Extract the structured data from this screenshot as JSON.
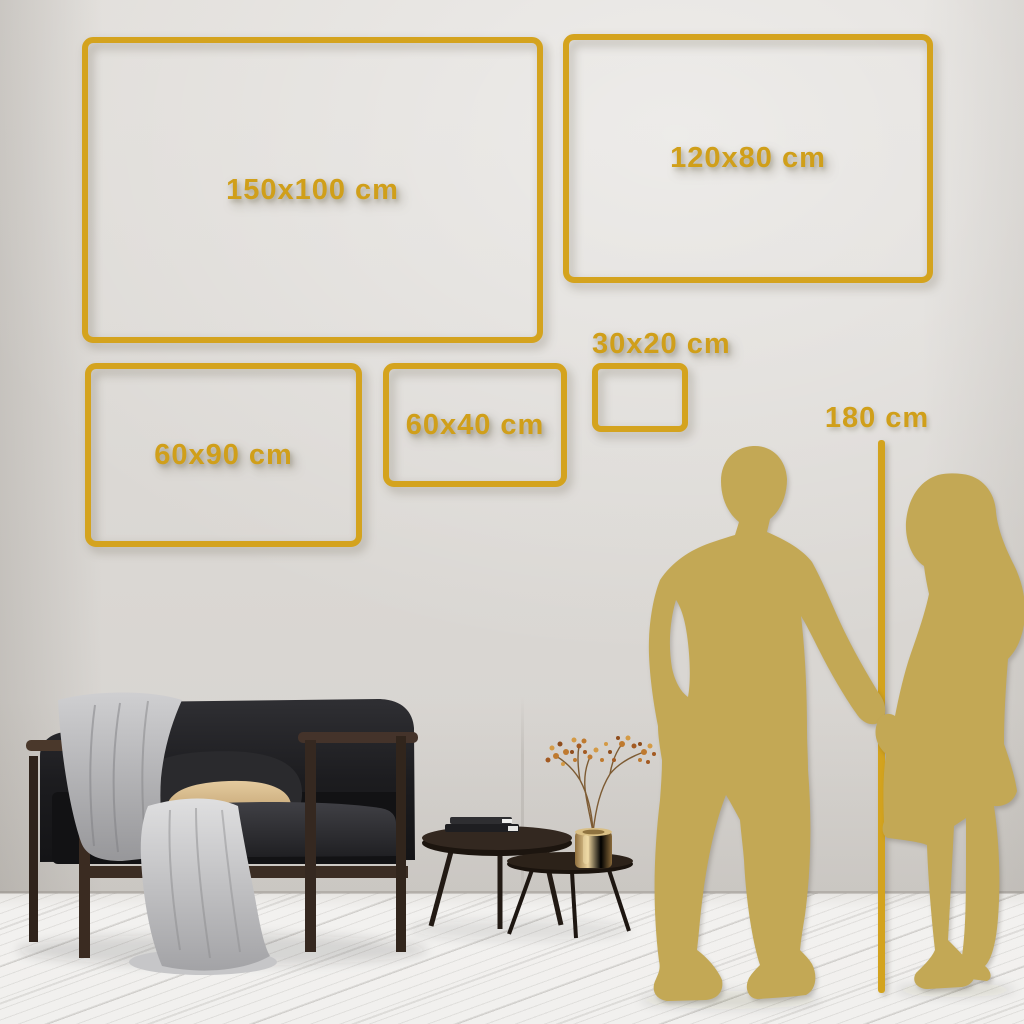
{
  "title": "Canvas wall art size guide",
  "unit": "cm",
  "colors": {
    "accent_gold": "#D4A31E",
    "silhouette_gold": "#C3A855",
    "wall": "#DBD8D4",
    "floor": "#F1F0EE"
  },
  "size_chart": {
    "type": "table",
    "frames": [
      {
        "id": "150x100",
        "label": "150x100 cm",
        "width_cm": 150,
        "height_cm": 100,
        "box_px": {
          "x": 82,
          "y": 37,
          "w": 461,
          "h": 306
        },
        "label_placement": "center"
      },
      {
        "id": "120x80",
        "label": "120x80 cm",
        "width_cm": 120,
        "height_cm": 80,
        "box_px": {
          "x": 563,
          "y": 34,
          "w": 370,
          "h": 249
        },
        "label_placement": "center"
      },
      {
        "id": "60x90",
        "label": "60x90 cm",
        "width_cm": 60,
        "height_cm": 90,
        "box_px": {
          "x": 85,
          "y": 363,
          "w": 277,
          "h": 184
        },
        "label_placement": "center"
      },
      {
        "id": "60x40",
        "label": "60x40 cm",
        "width_cm": 60,
        "height_cm": 40,
        "box_px": {
          "x": 383,
          "y": 363,
          "w": 184,
          "h": 124
        },
        "label_placement": "center"
      },
      {
        "id": "30x20",
        "label": "30x20 cm",
        "width_cm": 30,
        "height_cm": 20,
        "box_px": {
          "x": 592,
          "y": 363,
          "w": 96,
          "h": 69
        },
        "label_placement": "above"
      }
    ],
    "height_reference": {
      "label": "180 cm",
      "height_cm": 180,
      "line_px": {
        "x": 878,
        "top": 440,
        "bottom": 993
      }
    }
  },
  "scene": {
    "room": {
      "wall": "light warm gray",
      "floor": "white-washed diagonal wood planks"
    },
    "objects": [
      "dark velvet sofa with wood frame",
      "gray throw blanket draped to floor",
      "dark gray pillow",
      "tan pillow",
      "nesting round coffee tables",
      "stacked books",
      "brass vase with dried berry branches",
      "gold man silhouette",
      "gold woman silhouette holding hands"
    ]
  }
}
